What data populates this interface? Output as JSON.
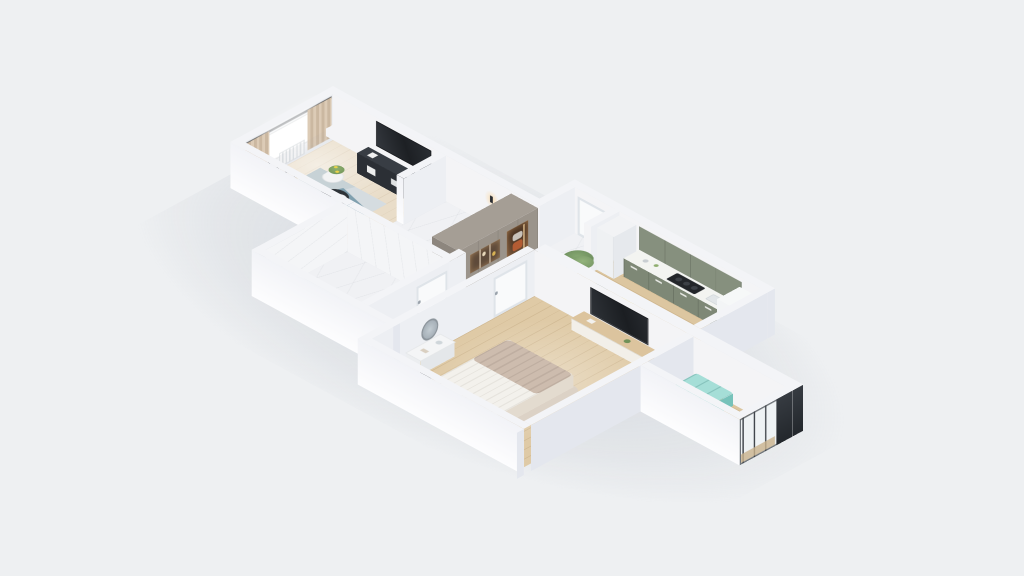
{
  "scene": {
    "type": "3d-isometric-floorplan-render",
    "description": "Photorealistic 3D isometric render of a one-bedroom apartment floor plan on a plain light gray background",
    "background": "#eef0f2"
  },
  "palette": {
    "background": "#eef0f2",
    "wall_top": "#f3f4f7",
    "wall_bright": "#fcfcfd",
    "wall_shadow": "#e4e7ee",
    "marble_floor": "#f0f1f4",
    "wood_warm": "#dfcaa6",
    "wood_light": "#e9ddc9",
    "kitchen_green": "#86907e",
    "wardrobe_taupe": "#9b948b",
    "niche_warm": "#b97f4e",
    "curtain_beige": "#d9c9b4",
    "rug_teal": "#7f9fae",
    "rug_slate": "#4e6d79",
    "bench_teal": "#a5ded7",
    "chair_yellow": "#e5c94f",
    "gold_brass": "#c9a44a",
    "tv_black": "#23262b"
  },
  "rooms": {
    "living": {
      "label": "Living room",
      "floor": "light wood",
      "items": [
        "window with white radiator",
        "beige curtains",
        "wall-mounted TV",
        "dark media console",
        "gold etagere shelf",
        "black round coffee table",
        "white side table with plant",
        "patchwork teal rug"
      ]
    },
    "hallway": {
      "label": "Hallway",
      "floor": "white marble",
      "items": [
        "taupe wardrobe with lit clothes niche",
        "decor shelf niche",
        "black wall sconces",
        "white bathroom door"
      ]
    },
    "bathroom": {
      "label": "Bathroom",
      "floor": "white marble",
      "items": [
        "white bathtub",
        "marble clad walls"
      ]
    },
    "kitchen": {
      "label": "Kitchen",
      "floor": "oak planks",
      "items": [
        "sage green upper cabinets",
        "sage green base cabinets with white counter",
        "dark cooktop",
        "tall white cabinet",
        "white fridge",
        "two chairs with yellow cushions",
        "tall green plant"
      ]
    },
    "bedroom": {
      "label": "Bedroom",
      "floor": "oak planks",
      "items": [
        "double bed with striped white duvet and beige throw",
        "wall-mounted TV above wood console",
        "white vanity desk with round mirror",
        "dark stool",
        "beige area rug",
        "white door"
      ]
    },
    "balcony": {
      "label": "Balcony",
      "floor": "oak planks",
      "items": [
        "turquoise storage bench",
        "glazed facade with dark frames"
      ]
    },
    "entry": {
      "label": "Entry",
      "items": [
        "white front door"
      ]
    }
  }
}
